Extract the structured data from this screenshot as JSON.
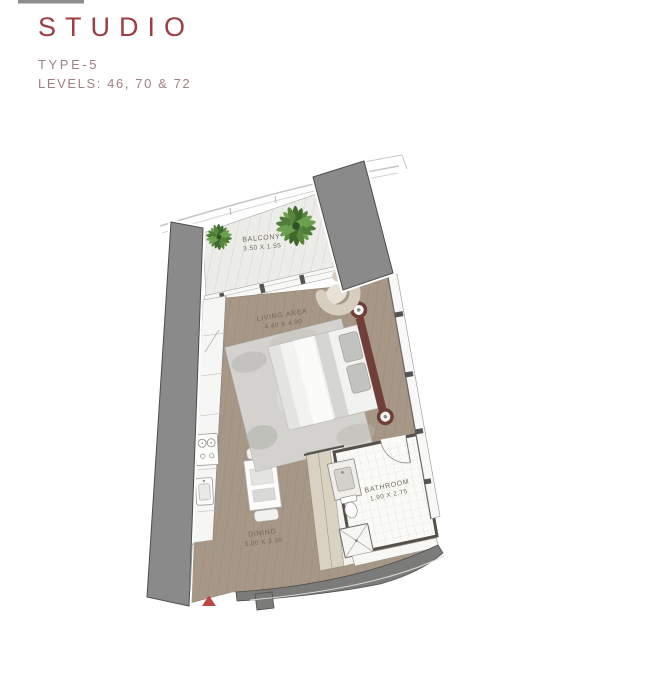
{
  "header": {
    "title": "STUDIO",
    "type": "TYPE-5",
    "levels": "LEVELS: 46, 70 & 72"
  },
  "rooms": [
    {
      "name": "BALCONY",
      "dims": "3.50 X 1.55"
    },
    {
      "name": "LIVING AREA",
      "dims": "4.40 X 4.90"
    },
    {
      "name": "DINING",
      "dims": "3.00 X 3.30"
    },
    {
      "name": "BATHROOM",
      "dims": "1.90 X 2.75"
    }
  ],
  "markers": {
    "entrance": "entrance-arrow"
  },
  "colors": {
    "title": "#9c3e43",
    "subtitle": "#9f8183",
    "fin": "#8a8a8a",
    "floor": "#a69787",
    "accent": "#bc4642",
    "headboard": "#6f3f38"
  }
}
